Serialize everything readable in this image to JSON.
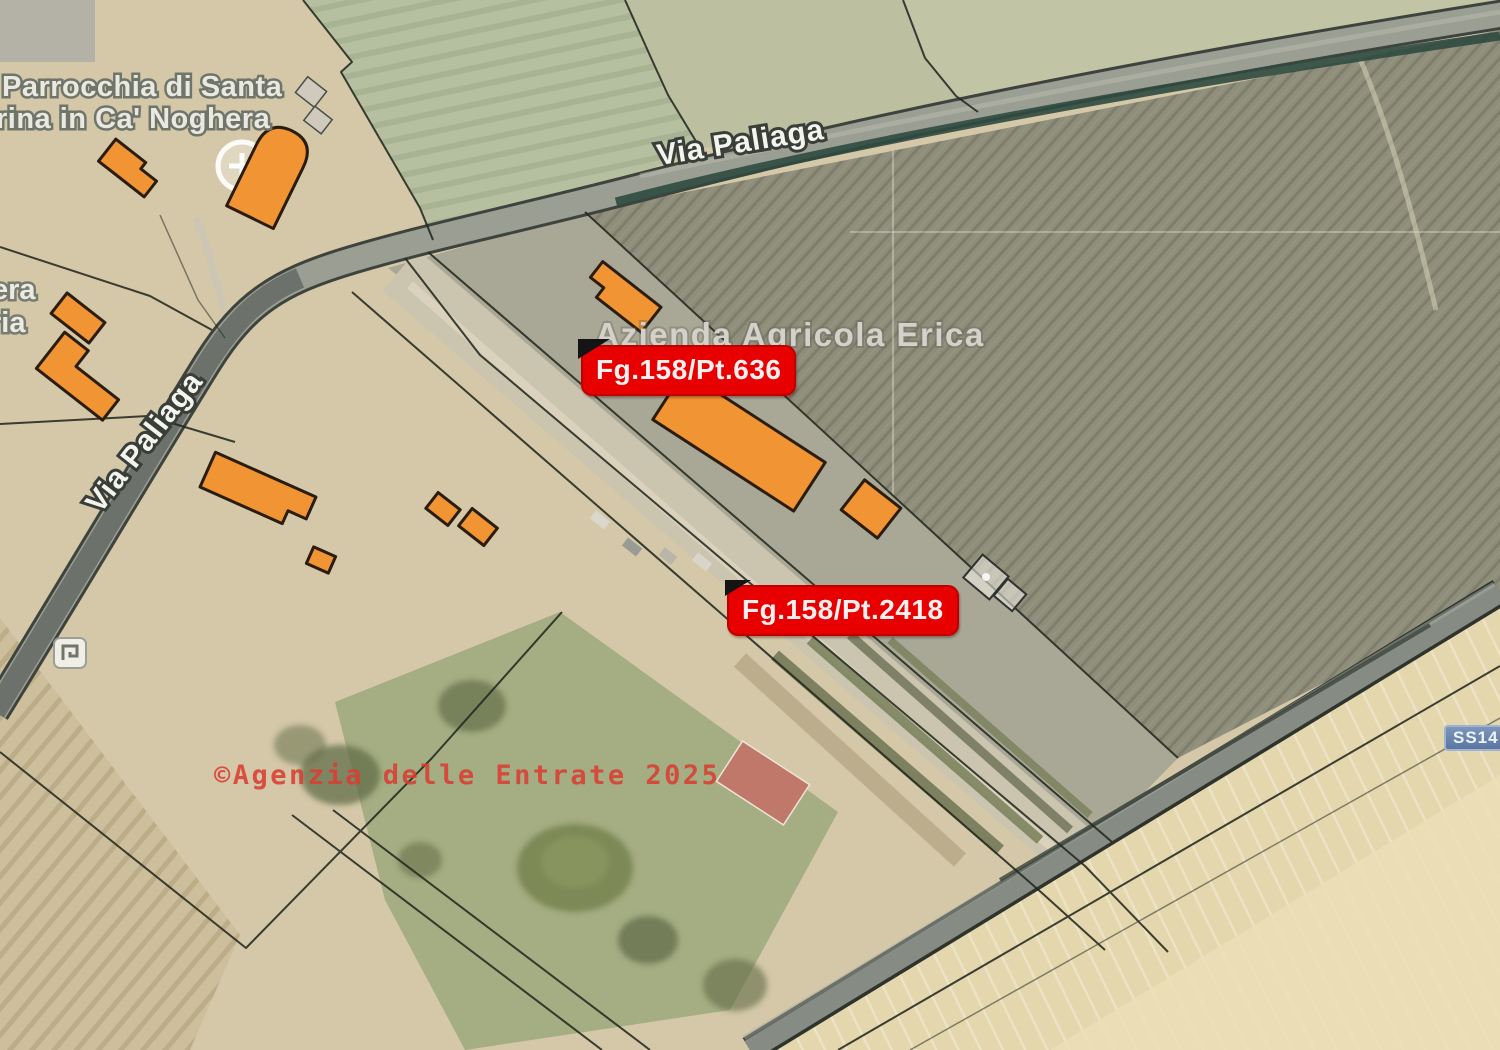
{
  "map": {
    "parcel_labels": [
      {
        "text": "Fg.158/Pt.636"
      },
      {
        "text": "Fg.158/Pt.2418"
      }
    ],
    "road_labels": [
      {
        "text": "Via Paliaga"
      },
      {
        "text": "Via Paliaga"
      }
    ],
    "place_labels": {
      "parrocchia_line1": "Parrocchia di Santa",
      "parrocchia_line2": "rina in Ca' Noghera",
      "azienda": "Azienda Agricola Erica",
      "fragment_left_1": "era",
      "fragment_left_2": "ria"
    },
    "watermark": "©Agenzia delle Entrate 2025",
    "road_badge": "SS14",
    "icons": {
      "church": "church-cross-icon",
      "monument": "monument-icon"
    },
    "colors": {
      "building_fill": "#f09434",
      "building_stroke": "#2b1d0e",
      "parcel_label_bg": "#e80000",
      "parcel_label_text": "#ffffff",
      "road_badge_bg": "#5f7aa4",
      "watermark_red": "#d83e32",
      "field_olive": "#8f8e7b",
      "road_grey": "#999d93"
    }
  }
}
